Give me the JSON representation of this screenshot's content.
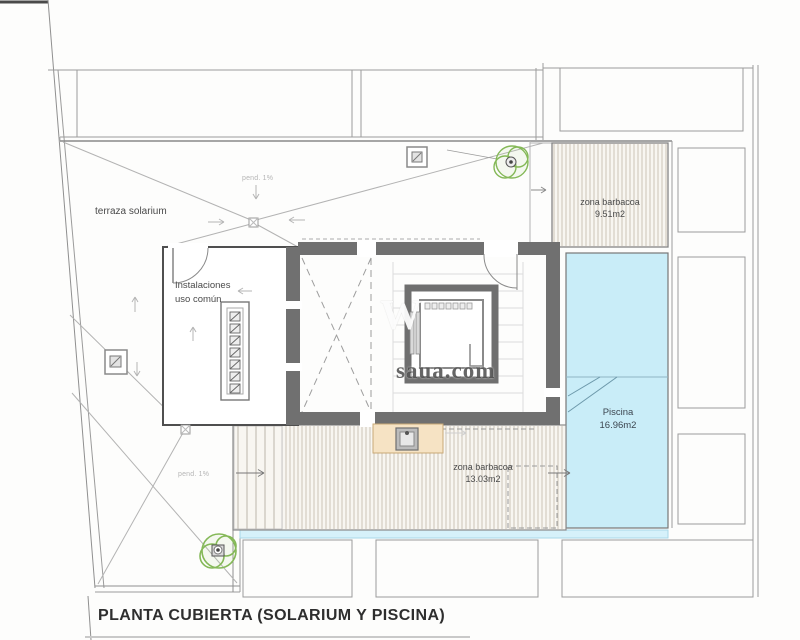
{
  "title_block": {
    "title": "PLANTA CUBIERTA (SOLARIUM Y PISCINA)"
  },
  "watermark": {
    "text": "saua.com",
    "ghost": "W"
  },
  "annotations": {
    "slope_top": "pend. 1%",
    "slope_left": "pend. 1%"
  },
  "rooms": {
    "terraza": {
      "label": "terraza solarium"
    },
    "instalaciones": {
      "line1": "Instalaciones",
      "line2": "uso común"
    },
    "barbacoa_top": {
      "label": "zona barbacoa",
      "area": "9.51m2"
    },
    "piscina": {
      "label": "Piscina",
      "area": "16.96m2"
    },
    "barbacoa_bottom": {
      "label": "zona barbacoa",
      "area": "13.03m2"
    }
  },
  "colors": {
    "wall_gray": "#707070",
    "pool_fill": "#c9edf8",
    "pool_band": "#d6f1fa",
    "deck_base": "#f8f6f1",
    "deck_hatch": "#cbc4b8",
    "counter_tan": "#f6e3c4",
    "plant_green": "#84b857",
    "label_text": "#4a4a4a"
  }
}
